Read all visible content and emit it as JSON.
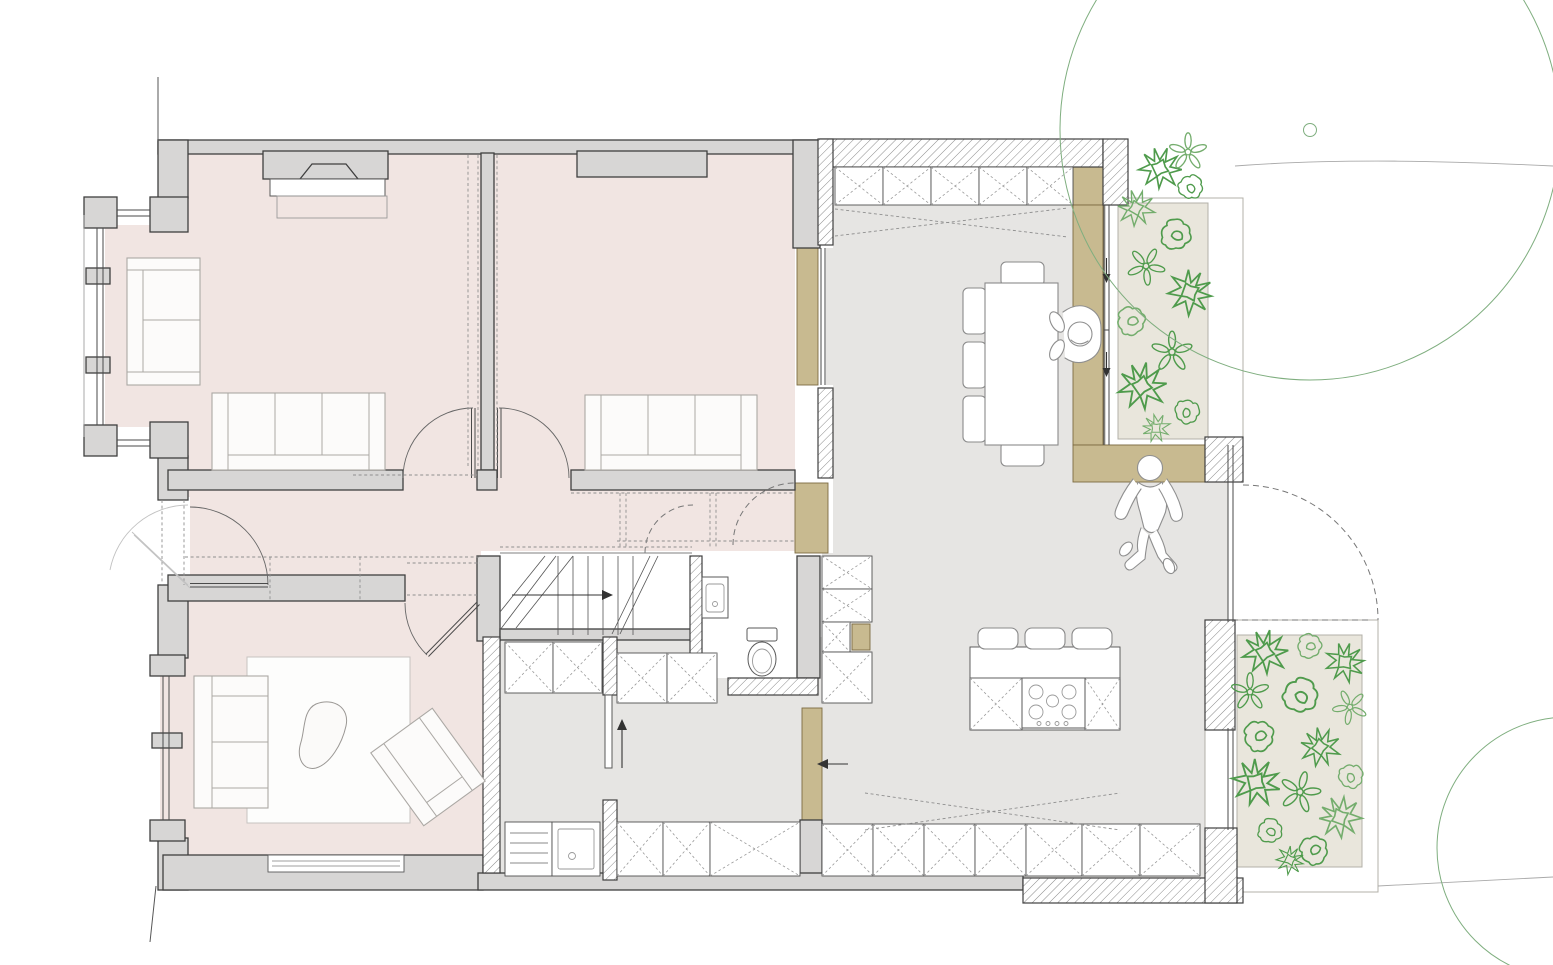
{
  "meta": {
    "kind": "architectural-floor-plan",
    "level": "ground-floor",
    "visible_text": []
  },
  "palette": {
    "room-pink": "#f1e5e2",
    "floor-gray": "#e6e5e3",
    "wall-fill": "#d7d6d5",
    "wall-stroke": "#3f3f3f",
    "tan": "#c8ba90",
    "tan-edge": "#7c6a42",
    "bed-fill": "#e9e6dc",
    "bed-frame": "#b3b0a8",
    "plant-green": "#4f9b4c",
    "plant-green-light": "#74ad6d",
    "tree-green": "#7fae7f",
    "furn-stroke": "#8a8a8a",
    "furn-light": "#aba8a4",
    "cab-stroke": "#4f4f4f",
    "cab-x": "#9a9a9a",
    "dash-gray": "#8f8f8f",
    "glass": "#4a4a4a",
    "site-line": "#a9a9a9",
    "person": "#8f8f8f",
    "hatch-line": "#8b8b8b"
  },
  "zones": [
    {
      "id": "front-room-1",
      "floor": "pink"
    },
    {
      "id": "front-room-2",
      "floor": "pink"
    },
    {
      "id": "hallway",
      "floor": "pink"
    },
    {
      "id": "sitting-room",
      "floor": "pink"
    },
    {
      "id": "stairs",
      "floor": "white"
    },
    {
      "id": "wc",
      "floor": "white"
    },
    {
      "id": "kitchen",
      "floor": "gray"
    },
    {
      "id": "dining-living",
      "floor": "gray"
    },
    {
      "id": "garden-bed-north",
      "floor": "planted"
    },
    {
      "id": "garden-bed-south",
      "floor": "planted"
    }
  ],
  "symbols": {
    "furniture": [
      "dresser",
      "sofa-3-seat",
      "sofa-3-seat",
      "sofa-2-seat",
      "armchair",
      "rug",
      "coffee-table-organic",
      "dining-table",
      "dining-chairs",
      "bar-stools"
    ],
    "fixtures": [
      "kitchen-island-hob-5-burner",
      "sink-with-drainer",
      "washbasin",
      "toilet",
      "base-cabinets-x",
      "wardrobe-cabinets-x"
    ],
    "circulation": [
      "stair-flight-up",
      "entry-double-swing-door",
      "internal-door-swings",
      "pocket-sliding-doors",
      "terrace-door-dashed"
    ],
    "landscape": [
      "planting-scribbles",
      "tree-canopy-arc",
      "tree-trunk-marker",
      "site-contour-lines"
    ],
    "people": [
      "person-seated-at-table",
      "person-standing-bending"
    ]
  },
  "counts": {
    "people": 2,
    "garden_beds": 2,
    "tree_arcs": 2
  }
}
